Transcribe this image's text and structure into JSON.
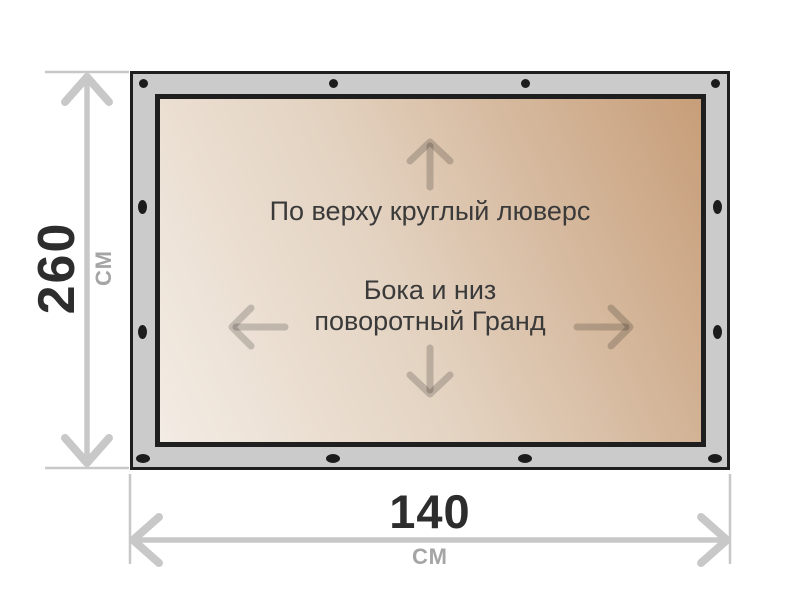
{
  "banner": {
    "surface": {
      "top_label": "По верху круглый люверс",
      "center_label_line1": "Бока и низ",
      "center_label_line2": "поворотный Гранд"
    },
    "colors": {
      "frame": "#cbcbcb",
      "outline": "#1f1f1f",
      "surface_gradient_start": "#f3ece4",
      "surface_gradient_end": "#c79e79",
      "grommet": "#1c1c1c",
      "edge_arrow": "rgba(0,0,0,0.18)"
    }
  },
  "dimensions": {
    "height_value": "260",
    "height_unit": "СМ",
    "width_value": "140",
    "width_unit": "СМ",
    "colors": {
      "dimension_line": "#c8c8c8",
      "value_text": "#2d2d2d",
      "unit_text": "#a5a5a5"
    }
  }
}
